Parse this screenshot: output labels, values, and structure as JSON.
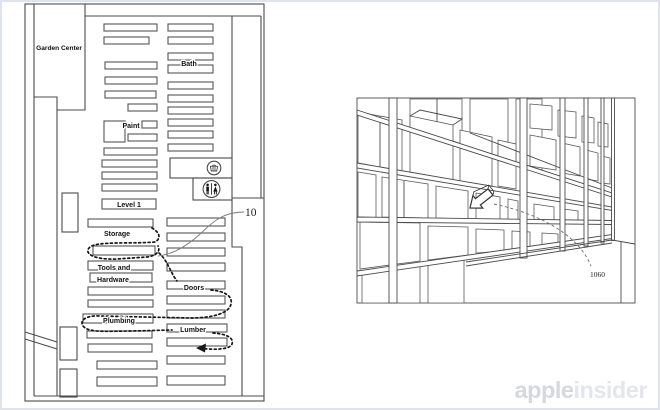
{
  "watermark": {
    "part1": "apple",
    "part2": "insider",
    "color1": "#d6d8de",
    "color2": "#e4e6ec"
  },
  "floor_plan": {
    "ref_number": "10",
    "labels": {
      "garden_center": "Garden Center",
      "bath": "Bath",
      "paint": "Paint",
      "level": "Level 1",
      "storage": "Storage",
      "tools_line1": "Tools and",
      "tools_line2": "Hardware",
      "doors": "Doors",
      "plumbing": "Plumbing",
      "lumber": "Lumber"
    },
    "icons": [
      "basket-icon",
      "restroom-icon"
    ]
  },
  "shelf_view": {
    "ref_number": "1060",
    "icons": [
      "location-arrow-icon"
    ]
  }
}
